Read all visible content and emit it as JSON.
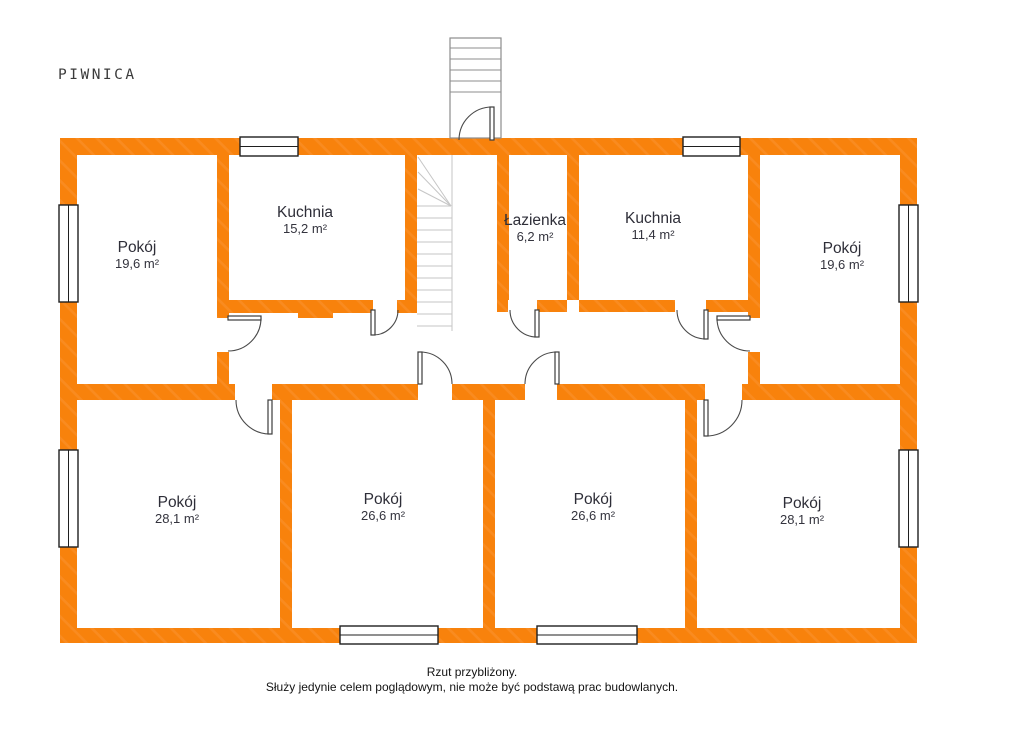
{
  "title": "PIWNICA",
  "rooms": {
    "pokoj_tl": {
      "name": "Pokój",
      "area": "19,6 m²"
    },
    "kuchnia_1": {
      "name": "Kuchnia",
      "area": "15,2 m²"
    },
    "lazienka": {
      "name": "Łazienka",
      "area": "6,2 m²"
    },
    "kuchnia_2": {
      "name": "Kuchnia",
      "area": "11,4 m²"
    },
    "pokoj_tr": {
      "name": "Pokój",
      "area": "19,6 m²"
    },
    "pokoj_bl": {
      "name": "Pokój",
      "area": "28,1 m²"
    },
    "pokoj_bml": {
      "name": "Pokój",
      "area": "26,6 m²"
    },
    "pokoj_bmr": {
      "name": "Pokój",
      "area": "26,6 m²"
    },
    "pokoj_br": {
      "name": "Pokój",
      "area": "28,1 m²"
    }
  },
  "footer": {
    "line1": "Rzut przybliżony.",
    "line2": "Służy jedynie celem poglądowym, nie może być podstawą prac budowlanych."
  },
  "colors": {
    "wall_orange": "#F8820C",
    "wall_hatch": "#FA9433",
    "window_border": "#1f1f1f",
    "door_line": "#4a4a4a",
    "stairs_outdoor": "#8d8d8d",
    "stairs_indoor": "#c6c6c6",
    "label_text": "#2e2e38",
    "footer_text": "#141414"
  },
  "plan": {
    "walls": [
      [
        60,
        138,
        857,
        17
      ],
      [
        60,
        628,
        857,
        15
      ],
      [
        60,
        155,
        17,
        473
      ],
      [
        900,
        155,
        17,
        473
      ],
      [
        217,
        155,
        12,
        163
      ],
      [
        217,
        352,
        12,
        33
      ],
      [
        217,
        300,
        156,
        13
      ],
      [
        298,
        313,
        35,
        5
      ],
      [
        397,
        300,
        20,
        13
      ],
      [
        405,
        155,
        12,
        158
      ],
      [
        497,
        155,
        12,
        145
      ],
      [
        497,
        300,
        11,
        12
      ],
      [
        537,
        300,
        30,
        12
      ],
      [
        567,
        155,
        12,
        145
      ],
      [
        579,
        300,
        96,
        12
      ],
      [
        706,
        300,
        54,
        12
      ],
      [
        748,
        155,
        12,
        163
      ],
      [
        748,
        352,
        12,
        33
      ],
      [
        60,
        384,
        175,
        16
      ],
      [
        272,
        384,
        146,
        16
      ],
      [
        452,
        384,
        73,
        16
      ],
      [
        557,
        384,
        148,
        16
      ],
      [
        742,
        384,
        175,
        16
      ],
      [
        280,
        400,
        12,
        228
      ],
      [
        483,
        400,
        12,
        228
      ],
      [
        685,
        400,
        12,
        228
      ]
    ],
    "windows": [
      {
        "x": 240,
        "y": 137,
        "w": 58,
        "h": 19,
        "o": "h"
      },
      {
        "x": 683,
        "y": 137,
        "w": 57,
        "h": 19,
        "o": "h"
      },
      {
        "x": 340,
        "y": 626,
        "w": 98,
        "h": 18,
        "o": "h"
      },
      {
        "x": 537,
        "y": 626,
        "w": 100,
        "h": 18,
        "o": "h"
      },
      {
        "x": 59,
        "y": 205,
        "w": 19,
        "h": 97,
        "o": "v"
      },
      {
        "x": 59,
        "y": 450,
        "w": 19,
        "h": 97,
        "o": "v"
      },
      {
        "x": 899,
        "y": 205,
        "w": 19,
        "h": 97,
        "o": "v"
      },
      {
        "x": 899,
        "y": 450,
        "w": 19,
        "h": 97,
        "o": "v"
      }
    ],
    "doors": [
      {
        "arc": "M492 107 A33 33 0 0 0 459 140",
        "leaf": [
          490,
          107,
          4,
          33
        ]
      },
      {
        "arc": "M261 318 A33 33 0 0 1 228 351",
        "leaf": [
          228,
          316,
          33,
          4
        ]
      },
      {
        "arc": "M717 318 A33 33 0 0 0 750 351",
        "leaf": [
          717,
          316,
          33,
          4
        ]
      },
      {
        "arc": "M373 335 A25 25 0 0 0 398 310",
        "leaf": [
          371,
          310,
          4,
          25
        ]
      },
      {
        "arc": "M537 337 A27 27 0 0 1 510 310",
        "leaf": [
          535,
          310,
          4,
          27
        ]
      },
      {
        "arc": "M706 339 A29 29 0 0 1 677 310",
        "leaf": [
          704,
          310,
          4,
          29
        ]
      },
      {
        "arc": "M270 434 A34 34 0 0 1 236 400",
        "leaf": [
          268,
          400,
          4,
          34
        ]
      },
      {
        "arc": "M420 352 A32 32 0 0 1 452 384",
        "leaf": [
          418,
          352,
          4,
          32
        ]
      },
      {
        "arc": "M557 352 A32 32 0 0 0 525 384",
        "leaf": [
          555,
          352,
          4,
          32
        ]
      },
      {
        "arc": "M706 436 A36 36 0 0 0 742 400",
        "leaf": [
          704,
          400,
          4,
          36
        ]
      }
    ],
    "stairs_outdoor": {
      "rect": [
        450,
        38,
        51,
        100
      ],
      "lines": [
        [
          450,
          48,
          501,
          48
        ],
        [
          450,
          59,
          501,
          59
        ],
        [
          450,
          70,
          501,
          70
        ],
        [
          450,
          81,
          501,
          81
        ],
        [
          450,
          92,
          501,
          92
        ]
      ]
    },
    "stairs_indoor": {
      "lines": [
        [
          452,
          155,
          452,
          331
        ],
        [
          451,
          206,
          418,
          157
        ],
        [
          451,
          206,
          418,
          172
        ],
        [
          451,
          206,
          418,
          189
        ],
        [
          417,
          206,
          451,
          206
        ],
        [
          417,
          218,
          452,
          218
        ],
        [
          417,
          230,
          452,
          230
        ],
        [
          417,
          242,
          452,
          242
        ],
        [
          417,
          254,
          452,
          254
        ],
        [
          417,
          266,
          452,
          266
        ],
        [
          417,
          278,
          452,
          278
        ],
        [
          417,
          290,
          452,
          290
        ],
        [
          417,
          302,
          452,
          302
        ],
        [
          417,
          314,
          452,
          314
        ],
        [
          417,
          326,
          452,
          326
        ]
      ]
    }
  }
}
